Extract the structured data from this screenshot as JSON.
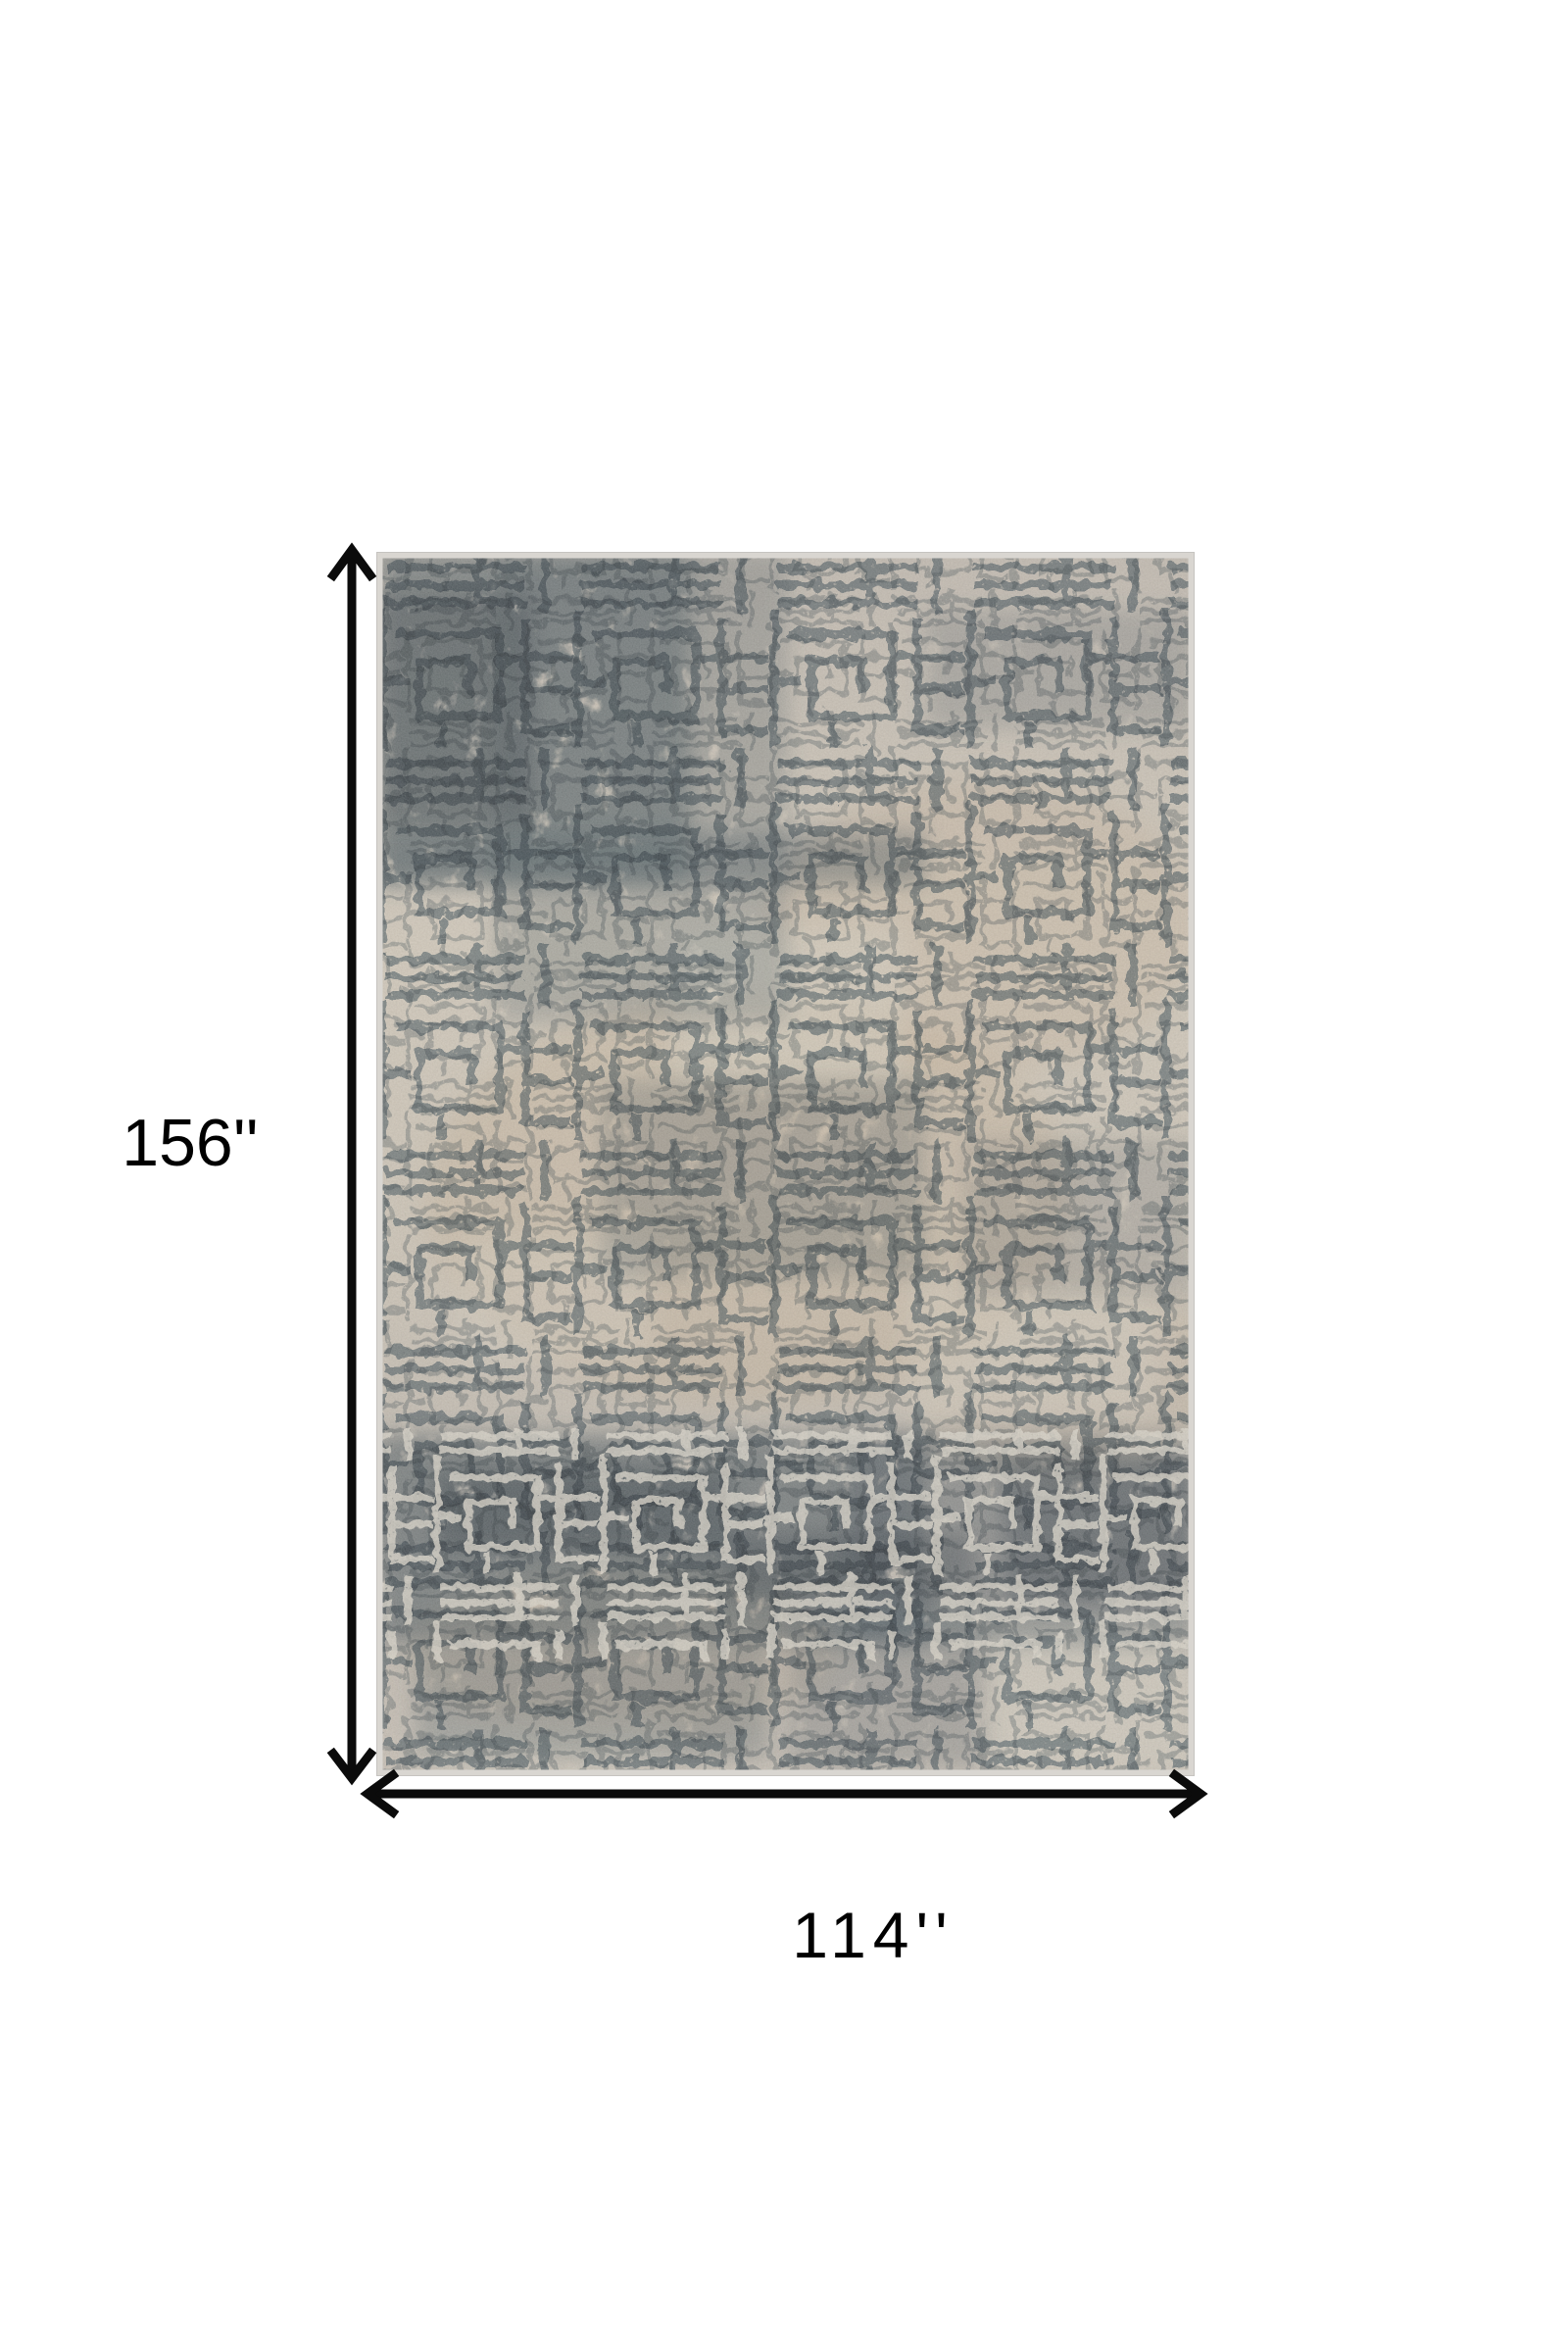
{
  "page": {
    "background_color": "#ffffff"
  },
  "diagram": {
    "height_label": "156''",
    "width_label": "114''",
    "arrow_color": "#0b0b0b",
    "label_color": "#000000",
    "rug_description": "distressed beige and blue-gray abstract maze area rug"
  },
  "rug": {
    "base_light": "#cbc1b0",
    "base_mid": "#c5bbab",
    "base_dark": "#b9b0a4",
    "tan": "#b99f7e",
    "accent": "#546d7d",
    "accent_light": "#73848f",
    "band": "#476073",
    "band_deep": "#3c556a",
    "light_line": "#d8d1c3",
    "patch_light": "#d2cbbc",
    "border": "#d9d6d1"
  }
}
